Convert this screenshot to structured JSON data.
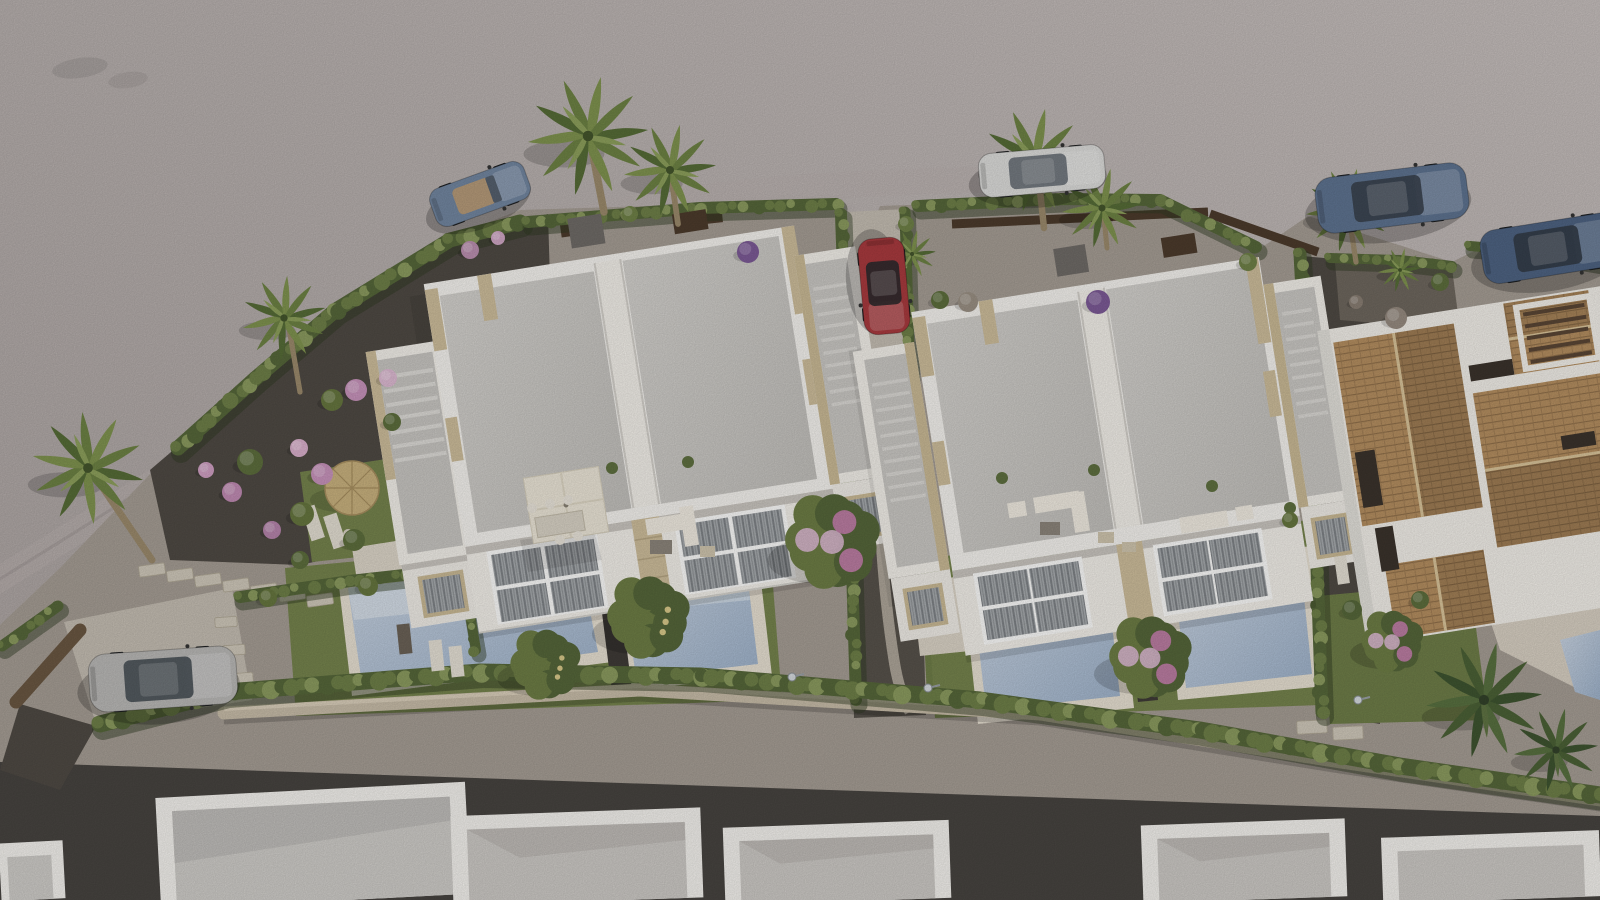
{
  "scene": {
    "description": "Aerial 3D architectural rendering of a coastal residential development: two modern white duplex villas with flat roofs, beige stone accents, roof-access stairs, private pools and landscaped gardens; a curved asphalt road at top-left, terracotta-roofed Mediterranean houses at right, a row of flat white roofs at bottom, cypress hedges, palm trees and six parked cars.",
    "palette": {
      "road": "#b6aeac",
      "road_light": "#c9c2c0",
      "road_shadow": "#9c938f",
      "curb": "#a39a98",
      "gravel_base": "#a59d94",
      "gravel_dark": "#4f4a44",
      "gravel_mid": "#57524b",
      "gravel_warm": "#6e675e",
      "lawn": "#75834d",
      "lawn_dark": "#5e6e3e",
      "hedge": "#6e7f48",
      "hedge_dark": "#56673a",
      "hedge_light": "#8b9b5f",
      "hedge_shadow": "#2f3a22",
      "pool_deep": "#9eb2ca",
      "pool_light": "#c9d4e2",
      "pool_step": "#d3dce6",
      "coping": "#e7e0d2",
      "white": "#f4f2ee",
      "white_warm": "#f2efe9",
      "white_dim": "#efece6",
      "facade_shadow": "#c9c5bf",
      "slab": "#c9c7c3",
      "slab_dark": "#b9b7b3",
      "stone": "#cdbd9b",
      "stone_dark": "#c9b995",
      "stone_wall": "#c7bca8",
      "stone_wall_hi": "#dacfbb",
      "terracotta": "#b48e60",
      "terracotta_dark": "#8f6f4a",
      "tile_line": "#9c7a52",
      "ridge": "#d9c49a",
      "wood": "#4c3b2c",
      "wood_wall": "#6a5742",
      "terrace": "#dcd5c8",
      "terrace_dim": "#d0c9bb",
      "concrete": "#c4bdb2",
      "path_light": "#b7aea2",
      "gray_box": "#6f6b67",
      "window_glass": "#a7abae",
      "blind": "#7e8286",
      "trunk": "#9b8a6c",
      "tree_green": "#55663a",
      "tree_green2": "#6d7d45",
      "fruit_dot": "#d9c98a",
      "flower_pink": "#c77fae",
      "flower_light": "#dcb9d1",
      "purple": "#7c5a96",
      "furn_white": "#f0ebe1",
      "furn_gray": "#8c857b",
      "straw": "#c8b17e",
      "straw_dark": "#a78f60",
      "lamp": "#d5dade"
    },
    "vehicles": [
      {
        "name": "blue-convertible",
        "color": "#7286a0",
        "glass": "#55606e",
        "x": 480,
        "y": 194,
        "len": 100,
        "wid": 40,
        "angle": -20,
        "style": "convertible"
      },
      {
        "name": "white-sedan",
        "color": "#dcdcda",
        "glass": "#6a7178",
        "x": 1042,
        "y": 171,
        "len": 126,
        "wid": 44,
        "angle": -5,
        "style": "sedan"
      },
      {
        "name": "blue-suv-1",
        "color": "#5e7390",
        "glass": "#39424e",
        "x": 1392,
        "y": 198,
        "len": 152,
        "wid": 56,
        "angle": -7,
        "style": "suv"
      },
      {
        "name": "blue-suv-2",
        "color": "#4e6382",
        "glass": "#333c48",
        "x": 1552,
        "y": 248,
        "len": 142,
        "wid": 54,
        "angle": -9,
        "style": "suv"
      },
      {
        "name": "red-hatchback",
        "color": "#a83a3e",
        "glass": "#2e2a2c",
        "x": 884,
        "y": 286,
        "len": 96,
        "wid": 46,
        "angle": 85,
        "style": "sedan"
      },
      {
        "name": "silver-suv",
        "color": "#b9b8b6",
        "glass": "#4a5158",
        "x": 163,
        "y": 679,
        "len": 148,
        "wid": 58,
        "angle": -4,
        "style": "suv"
      }
    ],
    "palms": [
      {
        "x": 588,
        "y": 136,
        "s": 1.5,
        "trunk": [
          [
            592,
            150
          ],
          [
            604,
            212
          ]
        ]
      },
      {
        "x": 670,
        "y": 170,
        "s": 1.15,
        "trunk": [
          [
            672,
            182
          ],
          [
            678,
            224
          ]
        ]
      },
      {
        "x": 1034,
        "y": 160,
        "s": 1.3,
        "trunk": [
          [
            1038,
            172
          ],
          [
            1044,
            228
          ]
        ]
      },
      {
        "x": 1102,
        "y": 208,
        "s": 1.0,
        "trunk": [
          [
            1104,
            218
          ],
          [
            1107,
            248
          ]
        ]
      },
      {
        "x": 1348,
        "y": 210,
        "s": 1.05,
        "trunk": [
          [
            1350,
            222
          ],
          [
            1356,
            262
          ]
        ]
      },
      {
        "x": 88,
        "y": 468,
        "s": 1.4,
        "r": 18,
        "trunk": [
          [
            92,
            472
          ],
          [
            152,
            560
          ]
        ]
      },
      {
        "x": 284,
        "y": 318,
        "s": 1.05,
        "r": -8,
        "trunk": [
          [
            288,
            322
          ],
          [
            300,
            392
          ]
        ]
      },
      {
        "x": 1484,
        "y": 700,
        "s": 1.45,
        "dark": 1
      },
      {
        "x": 1556,
        "y": 750,
        "s": 1.05,
        "dark": 1
      },
      {
        "x": 912,
        "y": 254,
        "s": 0.6
      },
      {
        "x": 1400,
        "y": 270,
        "s": 0.55
      }
    ],
    "hedges": [
      {
        "pts": [
          [
            178,
            448
          ],
          [
            256,
            378
          ],
          [
            336,
            310
          ],
          [
            450,
            240
          ],
          [
            520,
            222
          ]
        ],
        "w": 15
      },
      {
        "pts": [
          [
            528,
            222
          ],
          [
            700,
            208
          ],
          [
            836,
            204
          ]
        ],
        "w": 12
      },
      {
        "pts": [
          [
            841,
            214
          ],
          [
            845,
            330
          ],
          [
            849,
            470
          ],
          [
            853,
            600
          ],
          [
            856,
            700
          ]
        ],
        "w": 12
      },
      {
        "pts": [
          [
            905,
            212
          ],
          [
            908,
            320
          ],
          [
            911,
            436
          ]
        ],
        "w": 11
      },
      {
        "pts": [
          [
            918,
            206
          ],
          [
            1060,
            199
          ],
          [
            1160,
            200
          ],
          [
            1256,
            247
          ]
        ],
        "w": 12
      },
      {
        "pts": [
          [
            1300,
            254
          ],
          [
            1308,
            400
          ],
          [
            1316,
            540
          ],
          [
            1322,
            712
          ]
        ],
        "w": 13
      },
      {
        "pts": [
          [
            100,
            724
          ],
          [
            226,
            692
          ],
          [
            480,
            672
          ],
          [
            700,
            676
          ],
          [
            980,
            700
          ],
          [
            1200,
            730
          ],
          [
            1400,
            766
          ],
          [
            1600,
            795
          ]
        ],
        "w": 17
      },
      {
        "pts": [
          [
            240,
            597
          ],
          [
            350,
            581
          ],
          [
            458,
            569
          ]
        ],
        "w": 12
      },
      {
        "pts": [
          [
            463,
            573
          ],
          [
            476,
            650
          ]
        ],
        "w": 10
      },
      {
        "pts": [
          [
            2,
            646
          ],
          [
            58,
            606
          ]
        ],
        "w": 11
      },
      {
        "pts": [
          [
            1330,
            258
          ],
          [
            1400,
            260
          ],
          [
            1452,
            266
          ]
        ],
        "w": 10
      },
      {
        "pts": [
          [
            1470,
            246
          ],
          [
            1540,
            252
          ],
          [
            1600,
            262
          ]
        ],
        "w": 10
      }
    ],
    "shrubs": [
      {
        "x": 250,
        "y": 462,
        "r": 13,
        "c": "#5d6e3d"
      },
      {
        "x": 302,
        "y": 514,
        "r": 12,
        "c": "#66763f"
      },
      {
        "x": 354,
        "y": 540,
        "r": 11,
        "c": "#5d6e3d"
      },
      {
        "x": 332,
        "y": 400,
        "r": 11,
        "c": "#66763f"
      },
      {
        "x": 392,
        "y": 422,
        "r": 9,
        "c": "#5d6e3d"
      },
      {
        "x": 368,
        "y": 586,
        "r": 10,
        "c": "#66763f"
      },
      {
        "x": 300,
        "y": 560,
        "r": 9,
        "c": "#5d6e3d"
      },
      {
        "x": 356,
        "y": 390,
        "r": 11,
        "c": "#c793bb"
      },
      {
        "x": 388,
        "y": 378,
        "r": 9,
        "c": "#dcb9d1"
      },
      {
        "x": 232,
        "y": 492,
        "r": 10,
        "c": "#c08bb3"
      },
      {
        "x": 272,
        "y": 530,
        "r": 9,
        "c": "#b584ab"
      },
      {
        "x": 206,
        "y": 470,
        "r": 8,
        "c": "#cf9fc2"
      },
      {
        "x": 322,
        "y": 474,
        "r": 11,
        "c": "#c793bb"
      },
      {
        "x": 299,
        "y": 448,
        "r": 9,
        "c": "#d9afcb"
      },
      {
        "x": 470,
        "y": 250,
        "r": 9,
        "c": "#bb8fb0"
      },
      {
        "x": 498,
        "y": 238,
        "r": 7,
        "c": "#cfa6c4"
      },
      {
        "x": 748,
        "y": 252,
        "r": 11,
        "c": "#7c5a96"
      },
      {
        "x": 1098,
        "y": 302,
        "r": 12,
        "c": "#7c5a96"
      },
      {
        "x": 1248,
        "y": 262,
        "r": 9,
        "c": "#6f8147"
      },
      {
        "x": 630,
        "y": 214,
        "r": 8,
        "c": "#6f8147"
      },
      {
        "x": 906,
        "y": 224,
        "r": 8,
        "c": "#6f8147"
      },
      {
        "x": 1396,
        "y": 318,
        "r": 11,
        "c": "#968b80"
      },
      {
        "x": 1356,
        "y": 302,
        "r": 7,
        "c": "#897e73"
      },
      {
        "x": 968,
        "y": 302,
        "r": 10,
        "c": "#9a9084"
      },
      {
        "x": 940,
        "y": 300,
        "r": 9,
        "c": "#5d6e3d"
      },
      {
        "x": 1290,
        "y": 520,
        "r": 8,
        "c": "#66763f"
      },
      {
        "x": 1440,
        "y": 282,
        "r": 9,
        "c": "#5d6e3d"
      },
      {
        "x": 1500,
        "y": 270,
        "r": 8,
        "c": "#66763f"
      },
      {
        "x": 1352,
        "y": 610,
        "r": 10,
        "c": "#56673a"
      },
      {
        "x": 1420,
        "y": 600,
        "r": 9,
        "c": "#5d6e3d"
      },
      {
        "x": 268,
        "y": 598,
        "r": 9,
        "c": "#66763f"
      }
    ],
    "trees": [
      {
        "x": 648,
        "y": 618,
        "r": 40,
        "type": "fruit"
      },
      {
        "x": 545,
        "y": 665,
        "r": 34,
        "type": "fruit"
      },
      {
        "x": 832,
        "y": 542,
        "r": 46,
        "type": "boug"
      },
      {
        "x": 1150,
        "y": 658,
        "r": 40,
        "type": "boug"
      },
      {
        "x": 1392,
        "y": 642,
        "r": 30,
        "type": "boug"
      }
    ],
    "stepping_stones": [
      {
        "x": 152,
        "y": 570,
        "w": 26,
        "h": 11,
        "a": -8
      },
      {
        "x": 180,
        "y": 575,
        "w": 26,
        "h": 11,
        "a": -8
      },
      {
        "x": 208,
        "y": 580,
        "w": 26,
        "h": 11,
        "a": -8
      },
      {
        "x": 236,
        "y": 585,
        "w": 26,
        "h": 11,
        "a": -8
      },
      {
        "x": 264,
        "y": 590,
        "w": 26,
        "h": 11,
        "a": -8
      },
      {
        "x": 292,
        "y": 595,
        "w": 26,
        "h": 11,
        "a": -8
      },
      {
        "x": 320,
        "y": 600,
        "w": 26,
        "h": 11,
        "a": -8
      },
      {
        "x": 226,
        "y": 622,
        "w": 22,
        "h": 10,
        "a": -4
      },
      {
        "x": 234,
        "y": 650,
        "w": 22,
        "h": 10,
        "a": -4
      },
      {
        "x": 242,
        "y": 678,
        "w": 22,
        "h": 10,
        "a": -4
      },
      {
        "x": 1312,
        "y": 727,
        "w": 30,
        "h": 13,
        "a": -3
      },
      {
        "x": 1348,
        "y": 733,
        "w": 30,
        "h": 13,
        "a": -3
      }
    ],
    "lamps": [
      {
        "x": 792,
        "y": 677
      },
      {
        "x": 928,
        "y": 688
      },
      {
        "x": 1358,
        "y": 700
      }
    ]
  }
}
